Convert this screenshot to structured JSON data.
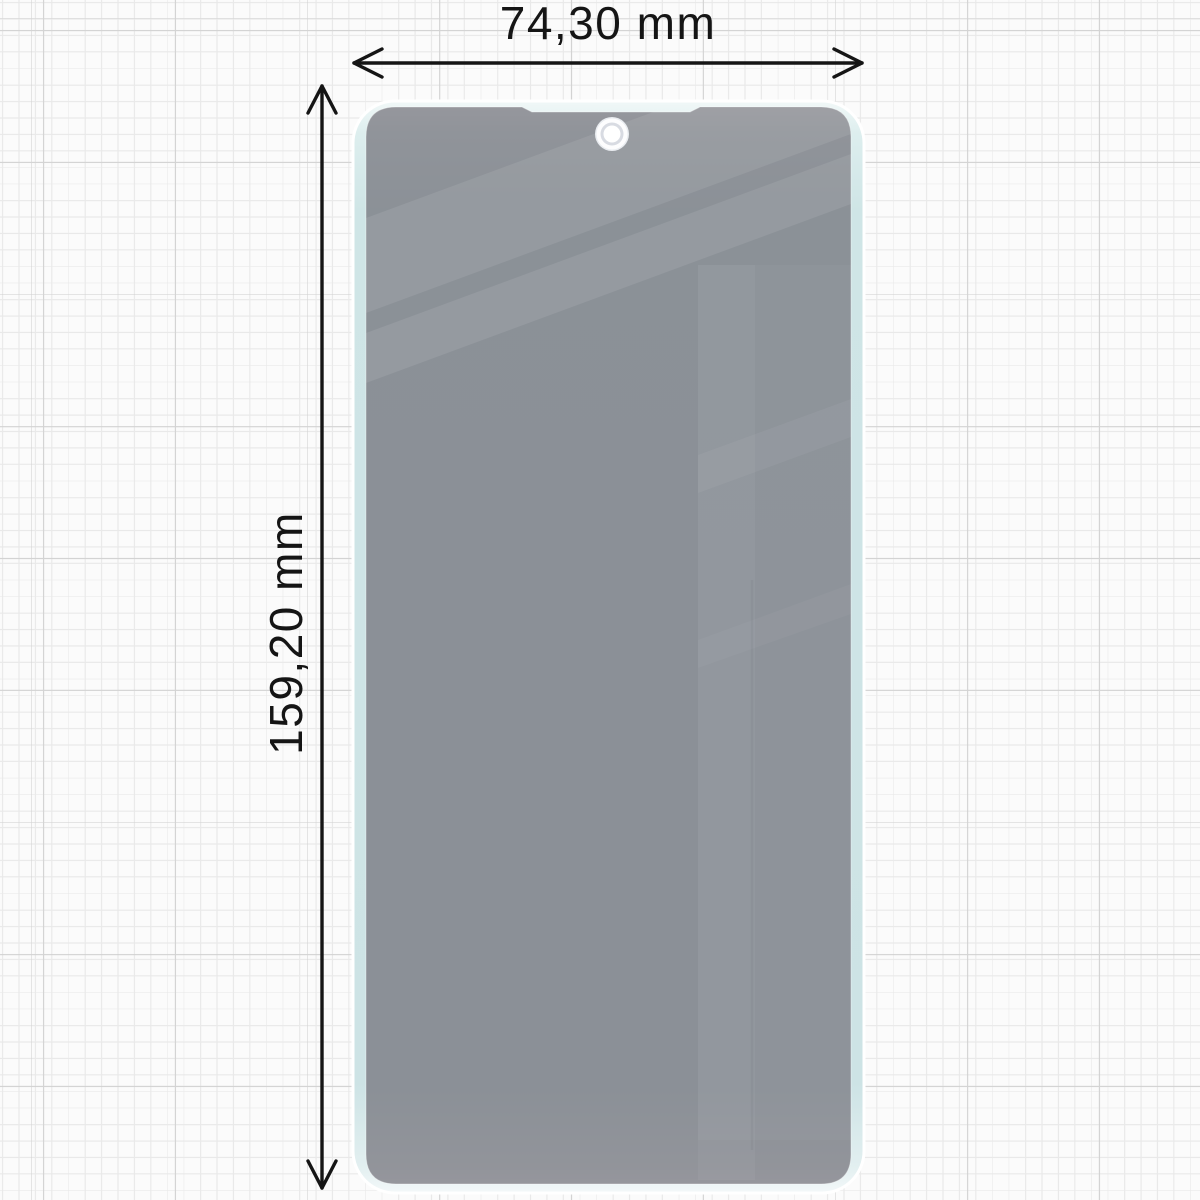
{
  "diagram": {
    "subject": "privacy-screen-protector-dimension-diagram",
    "width": {
      "label": "74,30 mm"
    },
    "height": {
      "label": "159,20 mm"
    }
  },
  "icons": {
    "camera_cutout": "punch-hole-camera-cutout",
    "width_arrow": "double-headed-horizontal-arrow",
    "height_arrow": "double-headed-vertical-arrow"
  },
  "colors": {
    "paper_background": "#fbfbfb",
    "grid_minor": "#e9e9e9",
    "grid_major": "#d3d3d3",
    "glass_edge_mint": "#cfe5e6",
    "glass_rim_white": "#f4fafa",
    "privacy_film_gray": "#9d9aa1",
    "reflection_light": "#a9a6ad",
    "camera_ring_gray": "#d8dbe2",
    "dimension_line": "#151515",
    "label_text": "#151515"
  }
}
